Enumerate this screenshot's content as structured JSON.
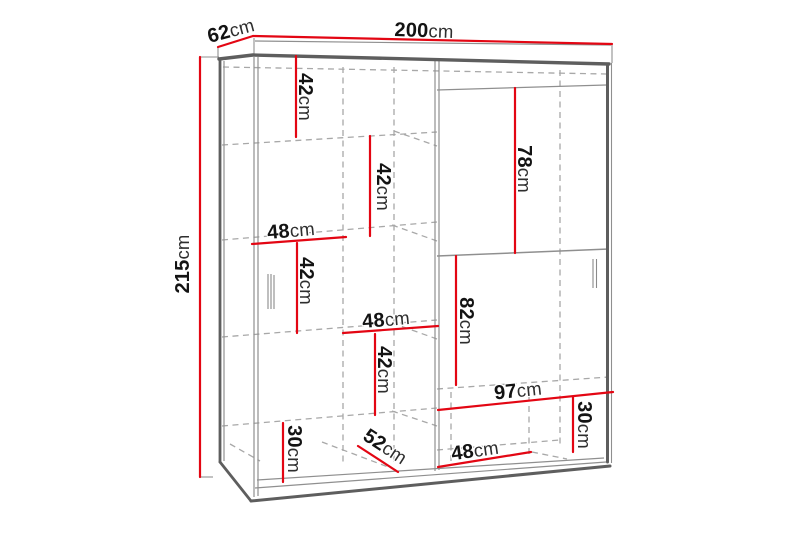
{
  "page": {
    "background": "#ffffff"
  },
  "diagram": {
    "kind": "wardrobe-dimension-diagram",
    "subject": "two-door sliding wardrobe line drawing with measurements",
    "unit": "cm",
    "colors": {
      "dimension_line": "#e30613",
      "outline": "#5e5e5e",
      "hidden_line": "#a8a8a8",
      "label_text": "#131313"
    },
    "overall": {
      "width": "200cm",
      "depth": "62cm",
      "height": "215cm"
    },
    "dims": [
      {
        "id": "depth",
        "value": "62",
        "unit": "cm"
      },
      {
        "id": "width",
        "value": "200",
        "unit": "cm"
      },
      {
        "id": "height",
        "value": "215",
        "unit": "cm"
      },
      {
        "id": "left-col-top-height",
        "value": "42",
        "unit": "cm"
      },
      {
        "id": "mid-col-upper-height",
        "value": "42",
        "unit": "cm"
      },
      {
        "id": "left-col-width",
        "value": "48",
        "unit": "cm"
      },
      {
        "id": "left-col-mid-height",
        "value": "42",
        "unit": "cm"
      },
      {
        "id": "mid-col-width",
        "value": "48",
        "unit": "cm"
      },
      {
        "id": "mid-col-lower-height",
        "value": "42",
        "unit": "cm"
      },
      {
        "id": "left-bottom-height",
        "value": "30",
        "unit": "cm"
      },
      {
        "id": "bottom-shelf-depth",
        "value": "52",
        "unit": "cm"
      },
      {
        "id": "right-bottom-width",
        "value": "48",
        "unit": "cm"
      },
      {
        "id": "right-top-height",
        "value": "78",
        "unit": "cm"
      },
      {
        "id": "right-mid-height",
        "value": "82",
        "unit": "cm"
      },
      {
        "id": "right-section-width",
        "value": "97",
        "unit": "cm"
      },
      {
        "id": "right-bottom-height",
        "value": "30",
        "unit": "cm"
      }
    ]
  }
}
